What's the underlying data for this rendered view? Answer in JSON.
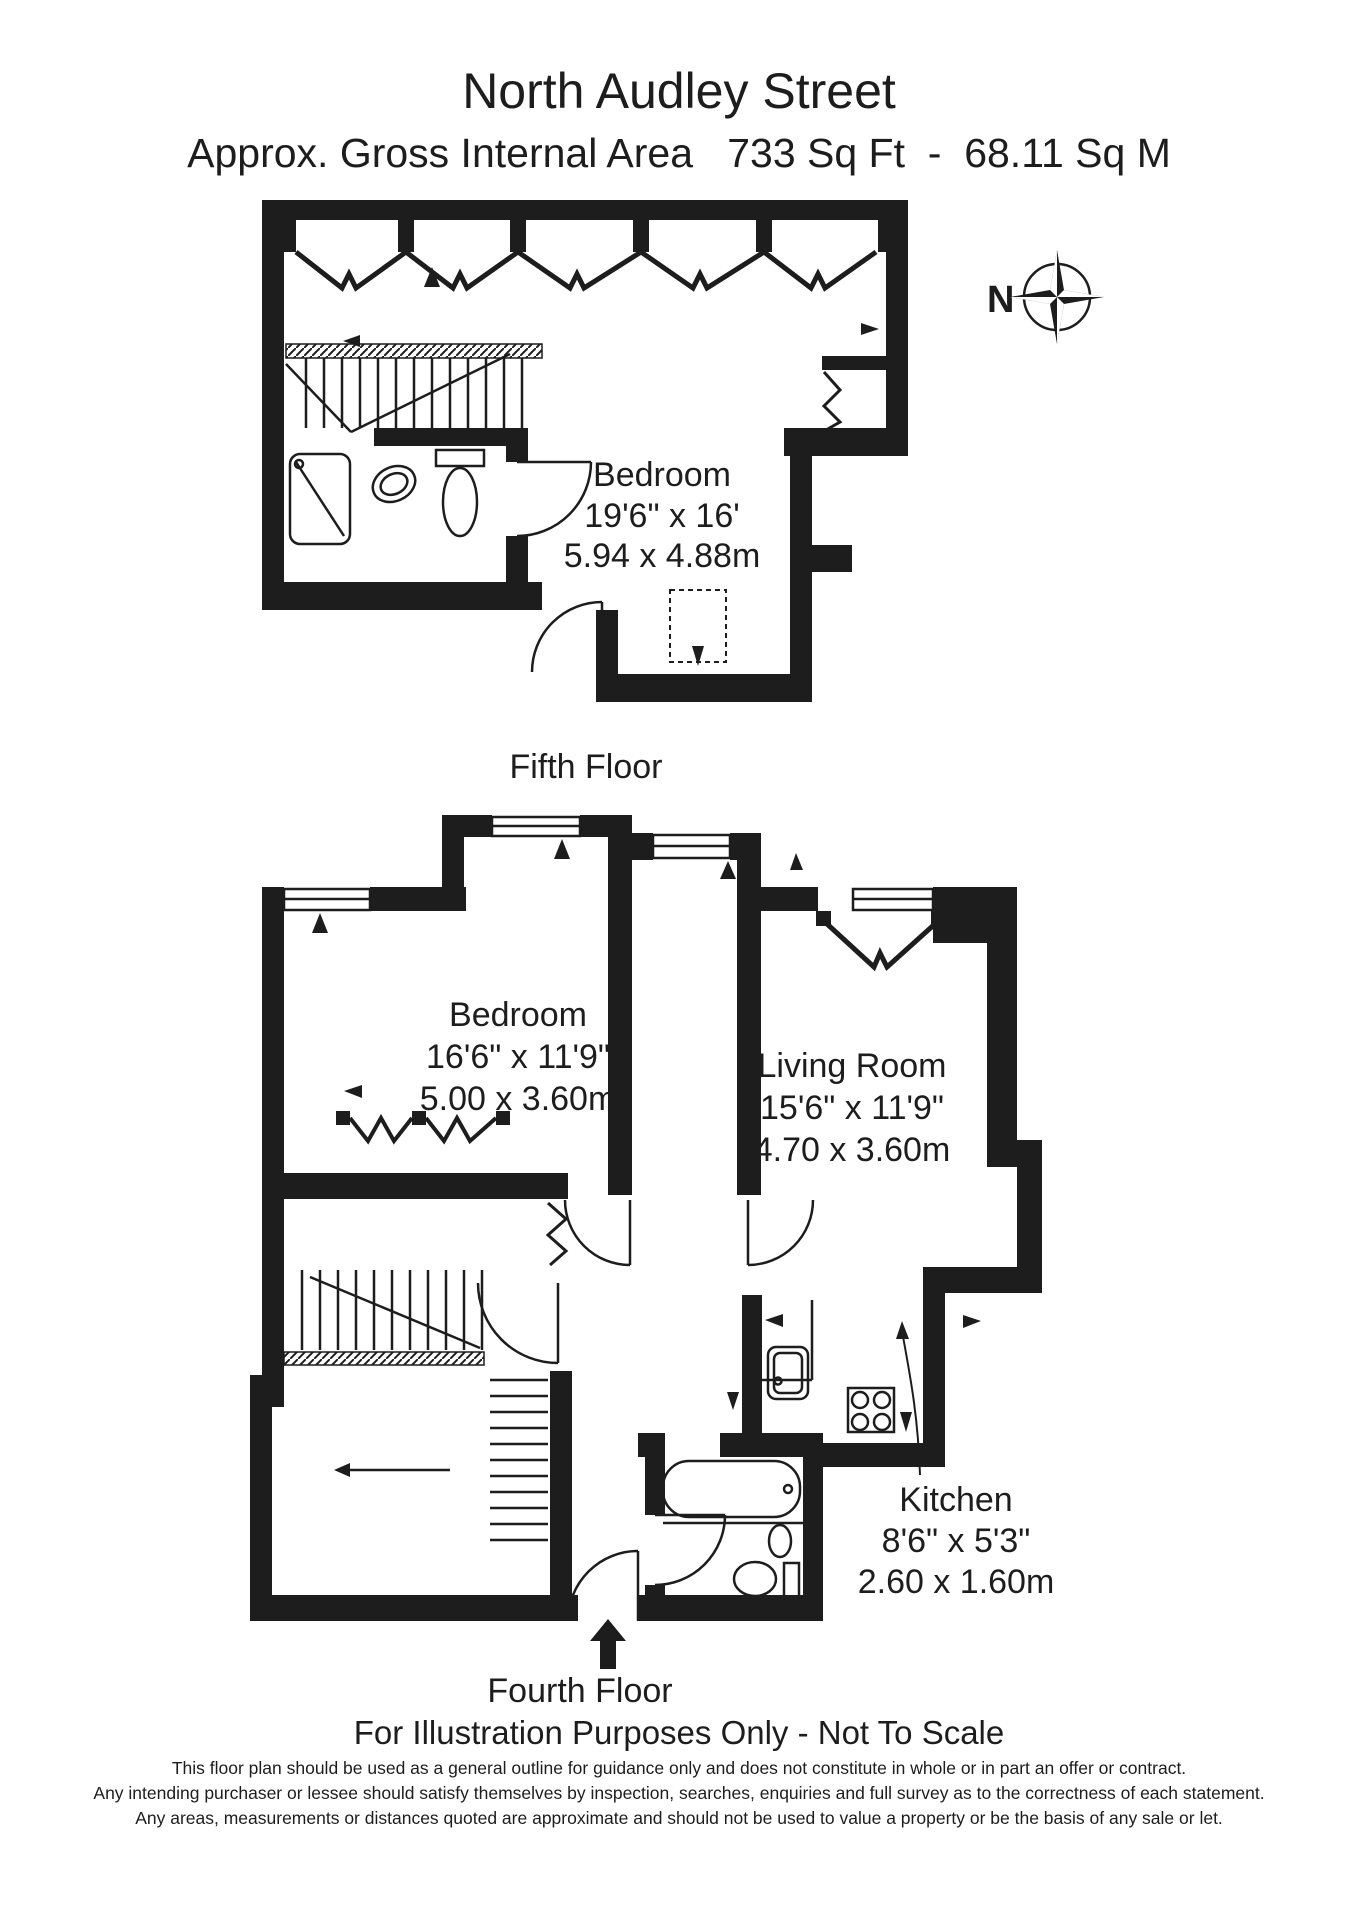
{
  "page": {
    "title": "North Audley Street",
    "subtitle": "Approx. Gross Internal Area   733 Sq Ft  -  68.11 Sq M",
    "note": "For Illustration Purposes Only - Not To Scale",
    "disclaimer_lines": [
      "This floor plan should be used as a general outline for guidance only and does not constitute in whole or in part an offer or contract.",
      "Any intending purchaser or lessee should satisfy themselves by inspection, searches, enquiries and full survey as to the correctness of each statement.",
      "Any areas, measurements or distances quoted are approximate and should not be used to value a property or be the basis of any sale or let."
    ]
  },
  "compass": {
    "label": "N"
  },
  "floors": [
    {
      "name": "Fifth Floor",
      "rooms": [
        {
          "name": "Bedroom",
          "imperial": "19'6\" x 16'",
          "metric": "5.94 x 4.88m"
        }
      ]
    },
    {
      "name": "Fourth Floor",
      "rooms": [
        {
          "name": "Bedroom",
          "imperial": "16'6\" x 11'9\"",
          "metric": "5.00 x 3.60m"
        },
        {
          "name": "Living Room",
          "imperial": "15'6\" x 11'9\"",
          "metric": "4.70 x 3.60m"
        },
        {
          "name": "Kitchen",
          "imperial": "8'6\" x 5'3\"",
          "metric": "2.60 x 1.60m"
        }
      ]
    }
  ],
  "colors": {
    "wall": "#1d1d1d",
    "background": "#ffffff"
  }
}
